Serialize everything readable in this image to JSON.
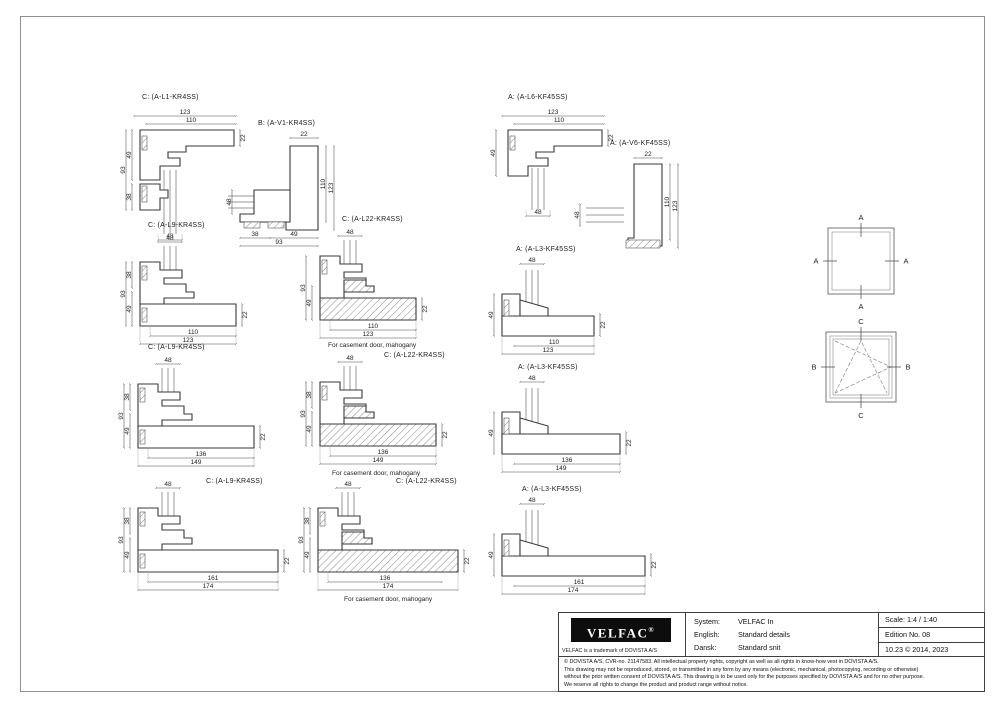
{
  "colors": {
    "line": "#3a3a3a",
    "dim_text": "#222222",
    "logo_bg": "#0d0d0d",
    "paper": "#ffffff"
  },
  "drawing": {
    "details": [
      {
        "label": "C: (A-L1-KR4SS)",
        "dims": {
          "top_outer": "123",
          "top_inner": "110",
          "left_outer": "93",
          "left_upper": "49",
          "left_lower": "38",
          "bottom": "48",
          "right": "22"
        }
      },
      {
        "label": "B: (A-V1-KR4SS)",
        "dims": {
          "top": "22",
          "right_inner": "110",
          "right_outer": "123",
          "left": "48",
          "bottom_left": "38",
          "bottom_right": "49",
          "bottom_outer": "93"
        }
      },
      {
        "label": "A: (A-L6-KF45SS)",
        "dims": {
          "top_outer": "123",
          "top_inner": "110",
          "left": "49",
          "bottom": "48",
          "right": "22"
        }
      },
      {
        "label": "A: (A-V6-KF45SS)",
        "dims": {
          "top": "22",
          "right_inner": "110",
          "right_outer": "123",
          "left": "48"
        }
      },
      {
        "label": "C: (A-L9-KR4SS)",
        "dims": {
          "top": "48",
          "left_upper": "38",
          "left_outer": "93",
          "left_lower": "49",
          "bottom_inner": "110",
          "bottom_outer": "123",
          "right": "22"
        }
      },
      {
        "label": "C: (A-L22-KR4SS)",
        "caption": "For casement door, mahogany",
        "dims": {
          "top": "48",
          "left_outer": "93",
          "left_lower": "49",
          "bottom_inner": "110",
          "bottom_outer": "123",
          "right": "22"
        }
      },
      {
        "label": "A: (A-L3-KF45SS)",
        "dims": {
          "top": "48",
          "left": "49",
          "bottom_inner": "110",
          "bottom_outer": "123",
          "right": "22"
        }
      },
      {
        "label": "C: (A-L9-KR4SS)",
        "dims": {
          "top": "48",
          "left_upper": "38",
          "left_outer": "93",
          "left_lower": "49",
          "bottom_inner": "136",
          "bottom_outer": "149",
          "right": "22"
        }
      },
      {
        "label": "C: (A-L22-KR4SS)",
        "caption": "For casement door, mahogany",
        "dims": {
          "top": "48",
          "left_upper": "38",
          "left_outer": "93",
          "left_lower": "49",
          "bottom_inner": "136",
          "bottom_outer": "149",
          "right": "22"
        }
      },
      {
        "label": "A: (A-L3-KF45SS)",
        "dims": {
          "top": "48",
          "left": "49",
          "bottom_inner": "136",
          "bottom_outer": "149",
          "right": "22"
        }
      },
      {
        "label": "C: (A-L9-KR4SS)",
        "dims": {
          "top": "48",
          "left_upper": "38",
          "left_outer": "93",
          "left_lower": "49",
          "bottom_inner": "161",
          "bottom_outer": "174",
          "right": "22"
        }
      },
      {
        "label": "C: (A-L22-KR4SS)",
        "caption": "For casement door, mahogany",
        "dims": {
          "top": "48",
          "left_upper": "38",
          "left_outer": "93",
          "left_lower": "49",
          "bottom_inner": "136",
          "bottom_outer": "174",
          "right": "22"
        }
      },
      {
        "label": "A: (A-L3-KF45SS)",
        "dims": {
          "top": "48",
          "left": "49",
          "bottom_inner": "161",
          "bottom_outer": "174",
          "right": "22"
        }
      }
    ],
    "elevations": {
      "fixed": {
        "top": "A",
        "left": "A",
        "right": "A",
        "bottom": "A"
      },
      "casement": {
        "top": "C",
        "left": "B",
        "right": "B",
        "bottom": "C"
      }
    }
  },
  "title_block": {
    "logo_text": "VELFAC",
    "logo_reg": "®",
    "trademark": "VELFAC is a trademark of DOVISTA A/S",
    "rows": [
      {
        "k": "System:",
        "v": "VELFAC In"
      },
      {
        "k": "English:",
        "v": "Standard details"
      },
      {
        "k": "Dansk:",
        "v": "Standard snit"
      }
    ],
    "meta": [
      "Scale: 1:4 / 1:40",
      "Edition No. 08",
      "10.23 © 2014, 2023"
    ],
    "copyright_lines": [
      "© DOVISTA A/S, CVR-no. 21147583. All intellectual property rights, copyright as well as all rights in know-how vest in DOVISTA A/S.",
      "This drawing may not be reproduced, stored, or transmitted in any form by any means (electronic, mechanical, photocopying, recording or otherwise)",
      "without the prior written consent of DOVISTA A/S. This drawing is to be used only for the purposes specified by DOVISTA A/S and for no other purpose.",
      "We reserve all rights to change the product and product range without notice."
    ]
  }
}
